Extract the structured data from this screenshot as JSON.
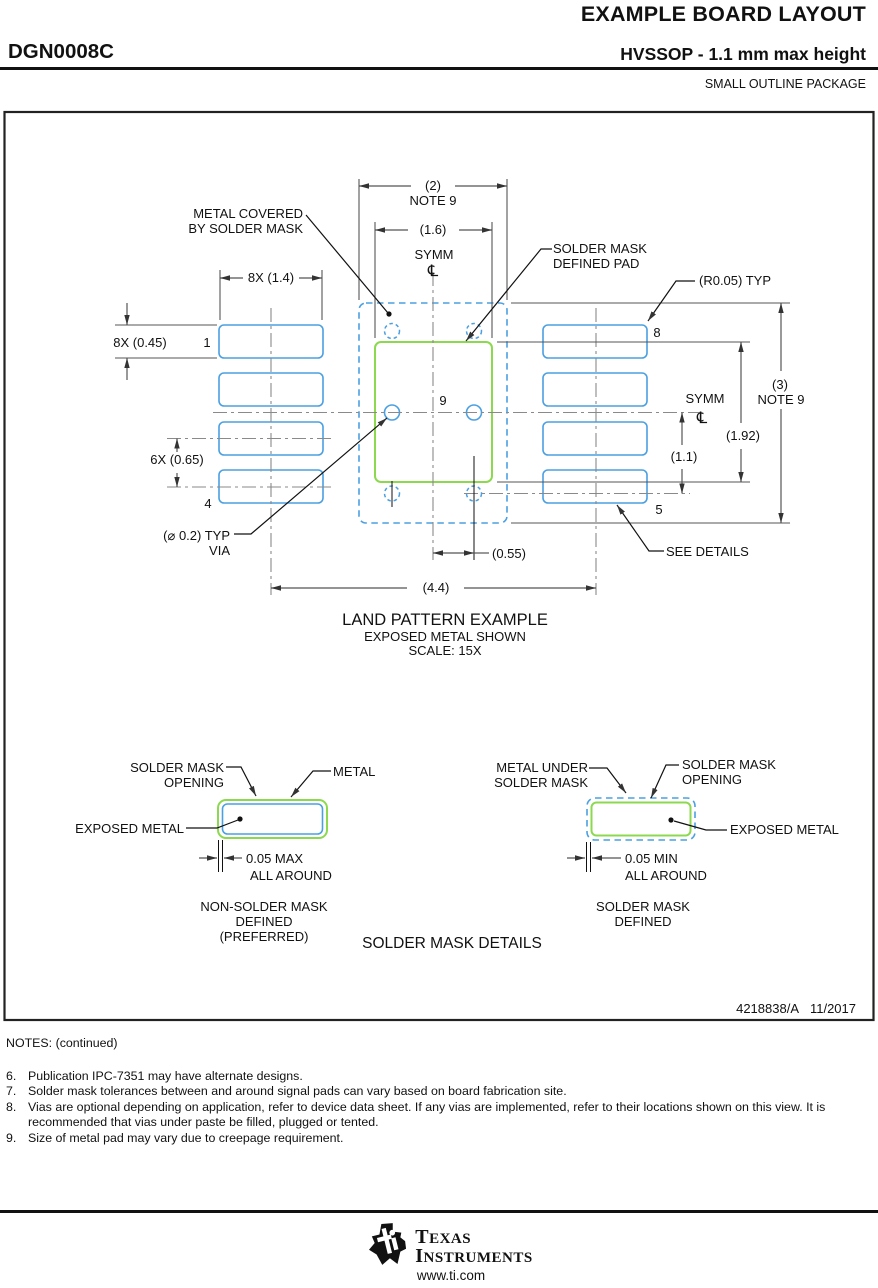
{
  "header": {
    "doc_title": "EXAMPLE BOARD LAYOUT",
    "part_code": "DGN0008C",
    "package_title": "HVSSOP - 1.1 mm max height",
    "package_family": "SMALL OUTLINE PACKAGE"
  },
  "land_pattern": {
    "labels": {
      "metal_covered_1": "METAL COVERED",
      "metal_covered_2": "BY SOLDER MASK",
      "smd_pad_1": "SOLDER MASK",
      "smd_pad_2": "DEFINED PAD",
      "r_typ": "(R0.05) TYP",
      "via_dia": "(⌀ 0.2) TYP",
      "via": "VIA",
      "see_details": "SEE DETAILS",
      "symm_top": "SYMM",
      "symm_right": "SYMM",
      "centerline_symbol": "℄"
    },
    "dims": {
      "d2": "(2)",
      "d2_note": "NOTE 9",
      "d16": "(1.6)",
      "d8x14": "8X (1.4)",
      "d8x045": "8X (0.45)",
      "d6x065": "6X (0.65)",
      "d055": "(0.55)",
      "d44": "(4.4)",
      "d11": "(1.1)",
      "d192": "(1.92)",
      "d3": "(3)",
      "d3_note": "NOTE 9"
    },
    "pins": {
      "p1": "1",
      "p4": "4",
      "p5": "5",
      "p8": "8",
      "p9": "9"
    },
    "title": "LAND PATTERN EXAMPLE",
    "subtitle1": "EXPOSED METAL SHOWN",
    "subtitle2": "SCALE: 15X"
  },
  "details": {
    "nsmd": {
      "mask_opening_1": "SOLDER MASK",
      "mask_opening_2": "OPENING",
      "metal": "METAL",
      "exposed_metal": "EXPOSED METAL",
      "clearance": "0.05 MAX",
      "all_around": "ALL AROUND",
      "caption_1": "NON-SOLDER MASK",
      "caption_2": "DEFINED",
      "caption_3": "(PREFERRED)"
    },
    "smd": {
      "metal_under_1": "METAL UNDER",
      "metal_under_2": "SOLDER MASK",
      "mask_opening_1": "SOLDER MASK",
      "mask_opening_2": "OPENING",
      "exposed_metal": "EXPOSED METAL",
      "clearance": "0.05 MIN",
      "all_around": "ALL AROUND",
      "caption_1": "SOLDER MASK",
      "caption_2": "DEFINED"
    },
    "title": "SOLDER MASK DETAILS"
  },
  "doc_block": {
    "doc_number": "4218838/A",
    "revision_date": "11/2017"
  },
  "notes": {
    "title": "NOTES: (continued)",
    "items": [
      {
        "num": "6.",
        "text": "Publication IPC-7351 may have alternate designs."
      },
      {
        "num": "7.",
        "text": "Solder mask tolerances between and around signal pads can vary based on board fabrication site."
      },
      {
        "num": "8.",
        "text": "Vias are optional depending on application, refer to device data sheet. If any vias are implemented, refer to their locations shown on this view. It is recommended that vias under paste be filled, plugged or tented."
      },
      {
        "num": "9.",
        "text": "Size of metal pad may vary due to creepage requirement."
      }
    ]
  },
  "footer": {
    "brand_1": "TEXAS",
    "brand_2": "INSTRUMENTS",
    "url": "www.ti.com"
  },
  "colors": {
    "pad_blue": "#4aa0e2",
    "metal_green": "#8cd94f",
    "centerline_gray": "#8a8a8a",
    "line_dark": "#555555"
  }
}
